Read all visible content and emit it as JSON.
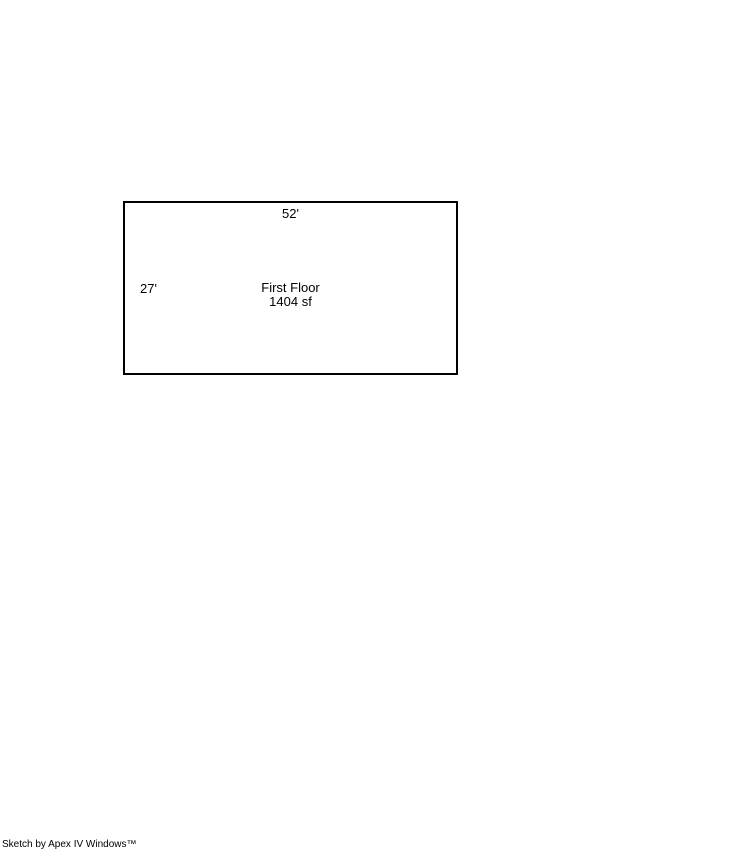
{
  "sketch": {
    "shape": "rectangle",
    "width_label": "52'",
    "height_label": "27'",
    "floor_label": "First Floor",
    "area_label": "1404 sf"
  },
  "footer": {
    "credit": "Sketch by Apex IV Windows™"
  },
  "colors": {
    "background": "#ffffff",
    "line": "#000000",
    "text": "#000000"
  }
}
